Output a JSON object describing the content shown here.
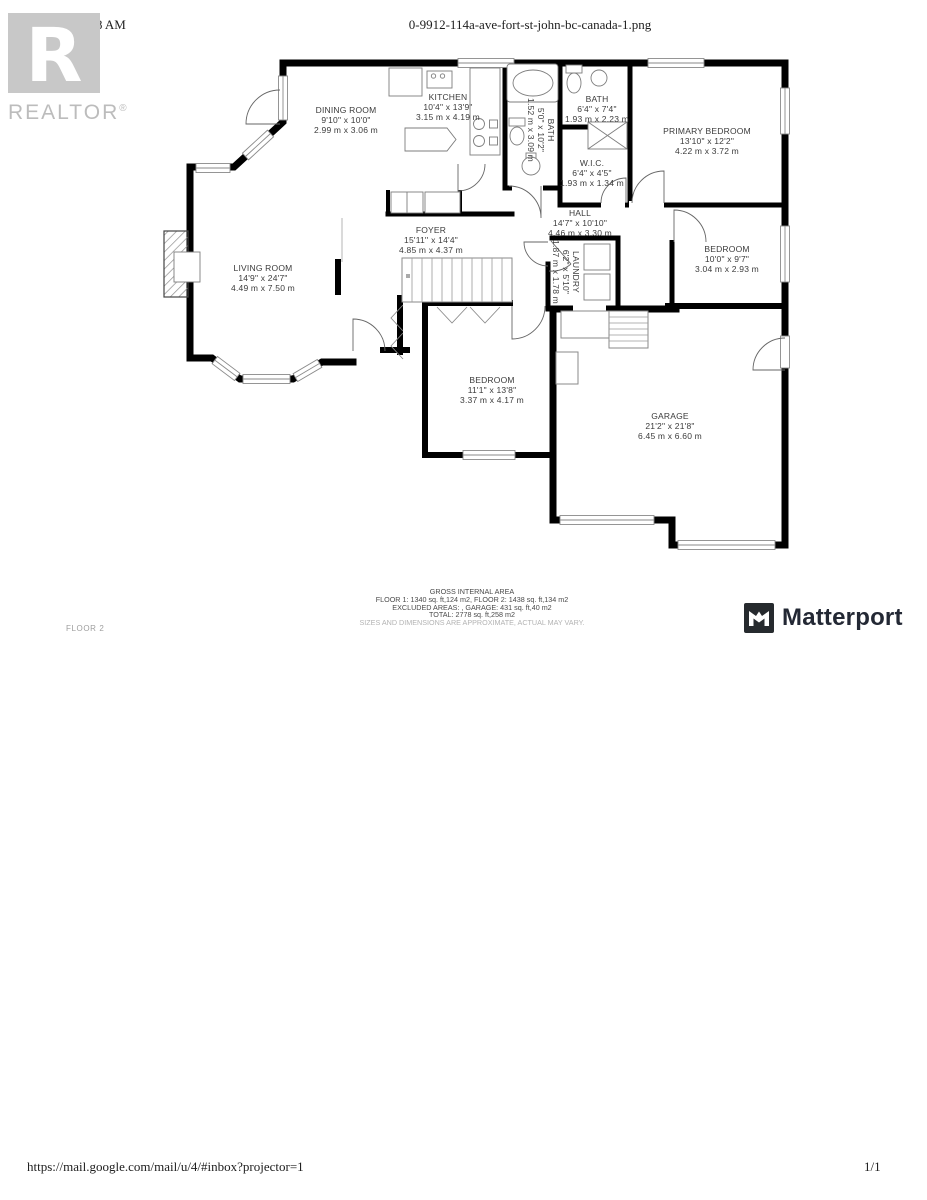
{
  "page": {
    "header": {
      "date": "6/2/22, 10:38 AM",
      "filename": "0-9912-114a-ave-fort-st-john-bc-canada-1.png"
    },
    "footer": {
      "url": "https://mail.google.com/mail/u/4/#inbox?projector=1",
      "page_indicator": "1/1"
    }
  },
  "branding": {
    "realtor_logo_letter": "R",
    "realtor_wordmark": "REALTOR",
    "realtor_reg_mark": "®",
    "matterport_wordmark": "Matterport"
  },
  "colors": {
    "walls": "#000000",
    "label_text": "#3b3b3b",
    "muted_gray": "#9e9e9e",
    "logo_gray": "#c8c8c8",
    "brand_dark": "#232834"
  },
  "floorplan": {
    "floor_label": "FLOOR 2",
    "rooms": [
      {
        "id": "dining-room",
        "name": "DINING ROOM",
        "imperial": "9'10\" x 10'0\"",
        "metric": "2.99 m x 3.06 m",
        "x": 346,
        "y": 120,
        "rotated": false
      },
      {
        "id": "kitchen",
        "name": "KITCHEN",
        "imperial": "10'4\" x 13'9\"",
        "metric": "3.15 m x 4.19 m",
        "x": 448,
        "y": 107,
        "rotated": false
      },
      {
        "id": "bath",
        "name": "BATH",
        "imperial": "6'4\" x 7'4\"",
        "metric": "1.93 m x 2.23 m",
        "x": 597,
        "y": 109,
        "rotated": false
      },
      {
        "id": "bath-2",
        "name": "BATH",
        "imperial": "5'0\" x 10'2\"",
        "metric": "1.52 m x 3.09 m",
        "x": 541,
        "y": 130,
        "rotated": true
      },
      {
        "id": "wic",
        "name": "W.I.C.",
        "imperial": "6'4\" x 4'5\"",
        "metric": "1.93 m x 1.34 m",
        "x": 592,
        "y": 173,
        "rotated": false
      },
      {
        "id": "primary-bedroom",
        "name": "PRIMARY BEDROOM",
        "imperial": "13'10\" x 12'2\"",
        "metric": "4.22 m x 3.72 m",
        "x": 707,
        "y": 141,
        "rotated": false
      },
      {
        "id": "hall",
        "name": "HALL",
        "imperial": "14'7\" x 10'10\"",
        "metric": "4.46 m x 3.30 m",
        "x": 580,
        "y": 223,
        "rotated": false
      },
      {
        "id": "foyer",
        "name": "FOYER",
        "imperial": "15'11'' x 14'4\"",
        "metric": "4.85 m x 4.37 m",
        "x": 431,
        "y": 240,
        "rotated": false
      },
      {
        "id": "living-room",
        "name": "LIVING ROOM",
        "imperial": "14'9\" x 24'7\"",
        "metric": "4.49 m x 7.50 m",
        "x": 263,
        "y": 278,
        "rotated": false
      },
      {
        "id": "laundry",
        "name": "LAUNDRY",
        "imperial": "6'2\" x 5'10\"",
        "metric": "1.87 m x 1.78 m",
        "x": 566,
        "y": 272,
        "rotated": true
      },
      {
        "id": "bedroom",
        "name": "BEDROOM",
        "imperial": "10'0\" x 9'7\"",
        "metric": "3.04 m x 2.93 m",
        "x": 727,
        "y": 259,
        "rotated": false
      },
      {
        "id": "bedroom-2",
        "name": "BEDROOM",
        "imperial": "11'1\" x 13'8\"",
        "metric": "3.37 m x 4.17 m",
        "x": 492,
        "y": 390,
        "rotated": false
      },
      {
        "id": "garage",
        "name": "GARAGE",
        "imperial": "21'2\" x 21'8\"",
        "metric": "6.45 m x 6.60 m",
        "x": 670,
        "y": 426,
        "rotated": false
      }
    ],
    "area_summary": {
      "title": "GROSS INTERNAL AREA",
      "line1": "FLOOR 1: 1340 sq. ft,124 m2, FLOOR 2: 1438 sq. ft,134 m2",
      "line2": "EXCLUDED AREAS: , GARAGE: 431 sq. ft,40 m2",
      "line3": "TOTAL: 2778 sq. ft,258 m2",
      "disclaimer": "SIZES AND DIMENSIONS ARE APPROXIMATE, ACTUAL MAY VARY."
    }
  }
}
